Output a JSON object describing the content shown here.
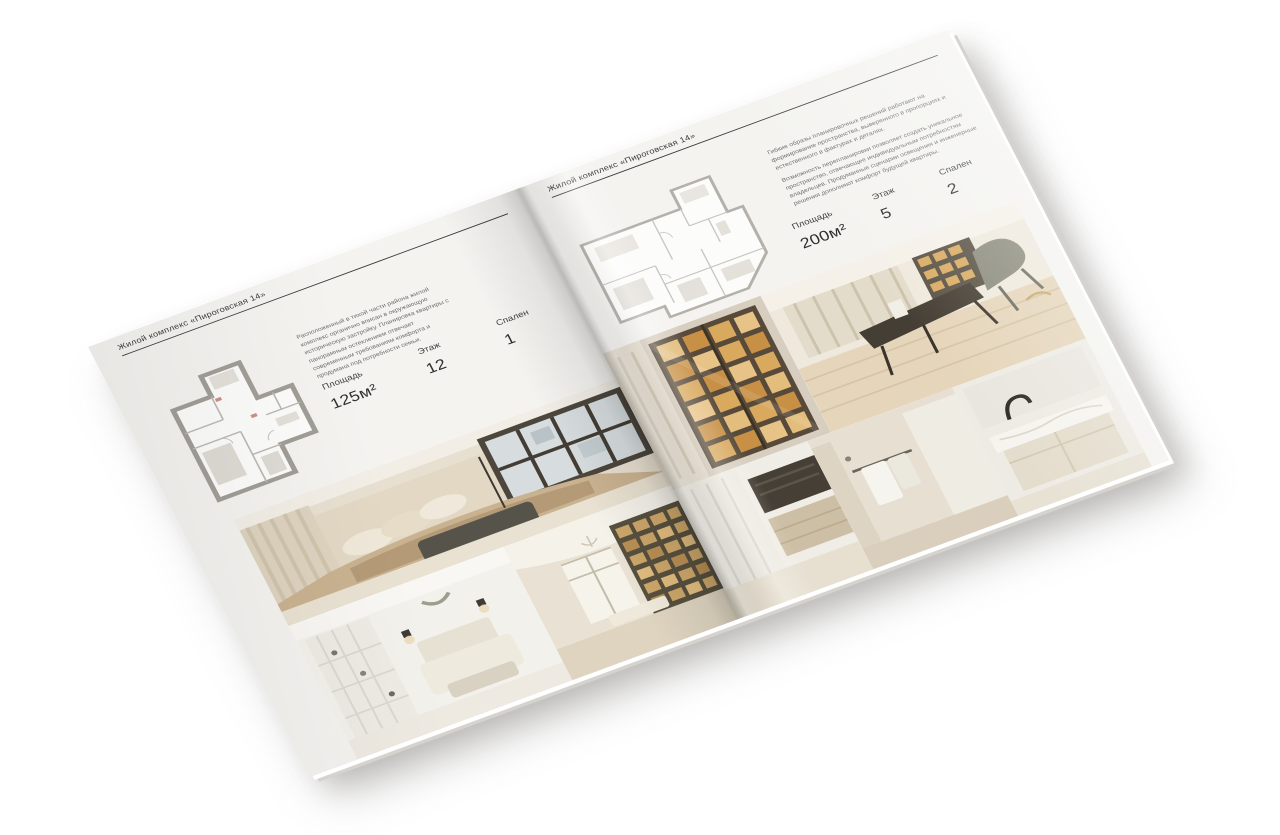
{
  "brochure": {
    "colors": {
      "background": "#ffffff",
      "page": "#f4f3f0",
      "headline_text": "#3c3c3c",
      "body_text": "#6e6e6e",
      "rule": "#3a3a3a",
      "plan_wall": "#a19d97",
      "photo_warm_accent": "#d2a663"
    },
    "left_page": {
      "header": "Жилой комплекс «Пироговская 14»",
      "description": "Расположенный в тихой части района жилой комплекс органично вписан в окружающую историческую застройку. Планировка квартиры с панорамным остеклением отвечает современным требованиям комфорта и продумана под потребности семьи.",
      "specs": [
        {
          "label": "Площадь",
          "value": "125м²"
        },
        {
          "label": "Этаж",
          "value": "12"
        },
        {
          "label": "Спален",
          "value": "1"
        }
      ],
      "floorplan": "apartment-plan-125m2",
      "photos": [
        {
          "name": "master-bedroom-photo"
        },
        {
          "name": "white-bedroom-photo"
        },
        {
          "name": "library-hallway-photo"
        }
      ]
    },
    "right_page": {
      "header": "Жилой комплекс «Пироговская 14»",
      "description_1": "Гибкие образы планировочных решений работают на формирование пространства, выверенного в пропорциях и естественного в фактурах и деталях.",
      "description_2": "Возможность перепланировки позволяет создать уникальное пространство, отвечающее индивидуальным потребностям владельцев. Продуманные сценарии освещения и инженерные решения дополняют комфорт будущей квартиры.",
      "specs": [
        {
          "label": "Площадь",
          "value": "200м²"
        },
        {
          "label": "Этаж",
          "value": "5"
        },
        {
          "label": "Спален",
          "value": "2"
        }
      ],
      "floorplan": "apartment-plan-200m2",
      "photos": [
        {
          "name": "display-cabinet-photo"
        },
        {
          "name": "study-room-photo"
        },
        {
          "name": "wardrobe-kitchen-photo"
        },
        {
          "name": "bathroom-towels-photo"
        },
        {
          "name": "marble-sink-photo"
        }
      ]
    }
  }
}
